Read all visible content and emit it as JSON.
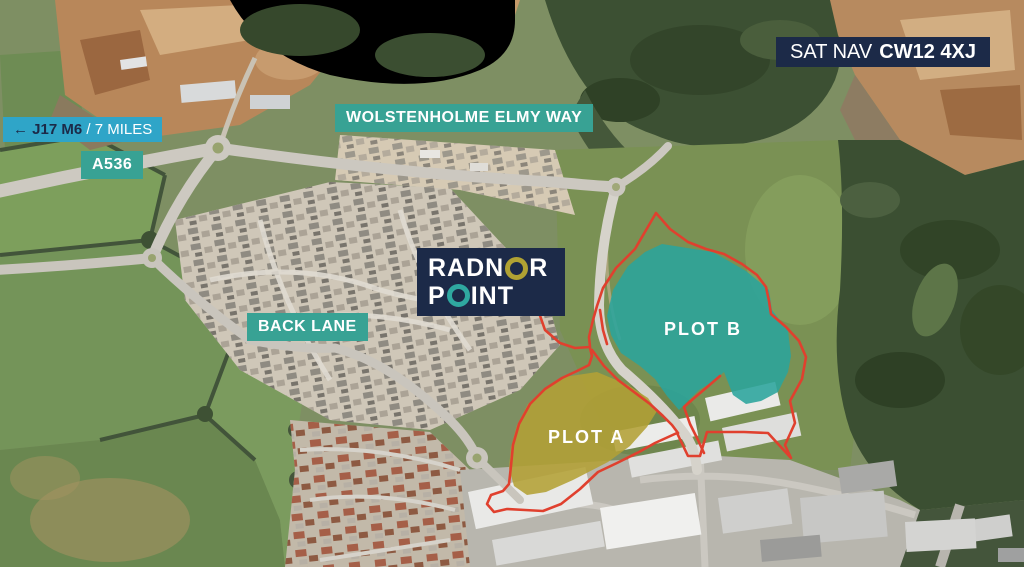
{
  "title": "Radnor Point aerial site plan",
  "sat_nav": {
    "prefix": "SAT NAV",
    "code": "CW12 4XJ"
  },
  "directions": {
    "junction": "← J17 M6",
    "distance": "/ 7 MILES"
  },
  "roads": {
    "a_road": "A536",
    "north_road": "WOLSTENHOLME ELMY WAY",
    "west_road": "BACK LANE"
  },
  "logo": {
    "word1": "RADNOR",
    "word1_pre": "RADN",
    "word1_post": "R",
    "word2": "POINT",
    "word2_pre": "P",
    "word2_post": "INT"
  },
  "plots": {
    "plot_a": "PLOT A",
    "plot_b": "PLOT B"
  },
  "colors": {
    "navy": "#1c2a48",
    "cyan_label": "#2fa5c8",
    "teal_label": "#38a294",
    "plot_a_fill": "#b3a136",
    "plot_b_fill": "#2aa49c",
    "boundary_red": "#e0402e",
    "logo_ring_gold": "#b0a233",
    "logo_ring_teal": "#2fa8a0"
  }
}
